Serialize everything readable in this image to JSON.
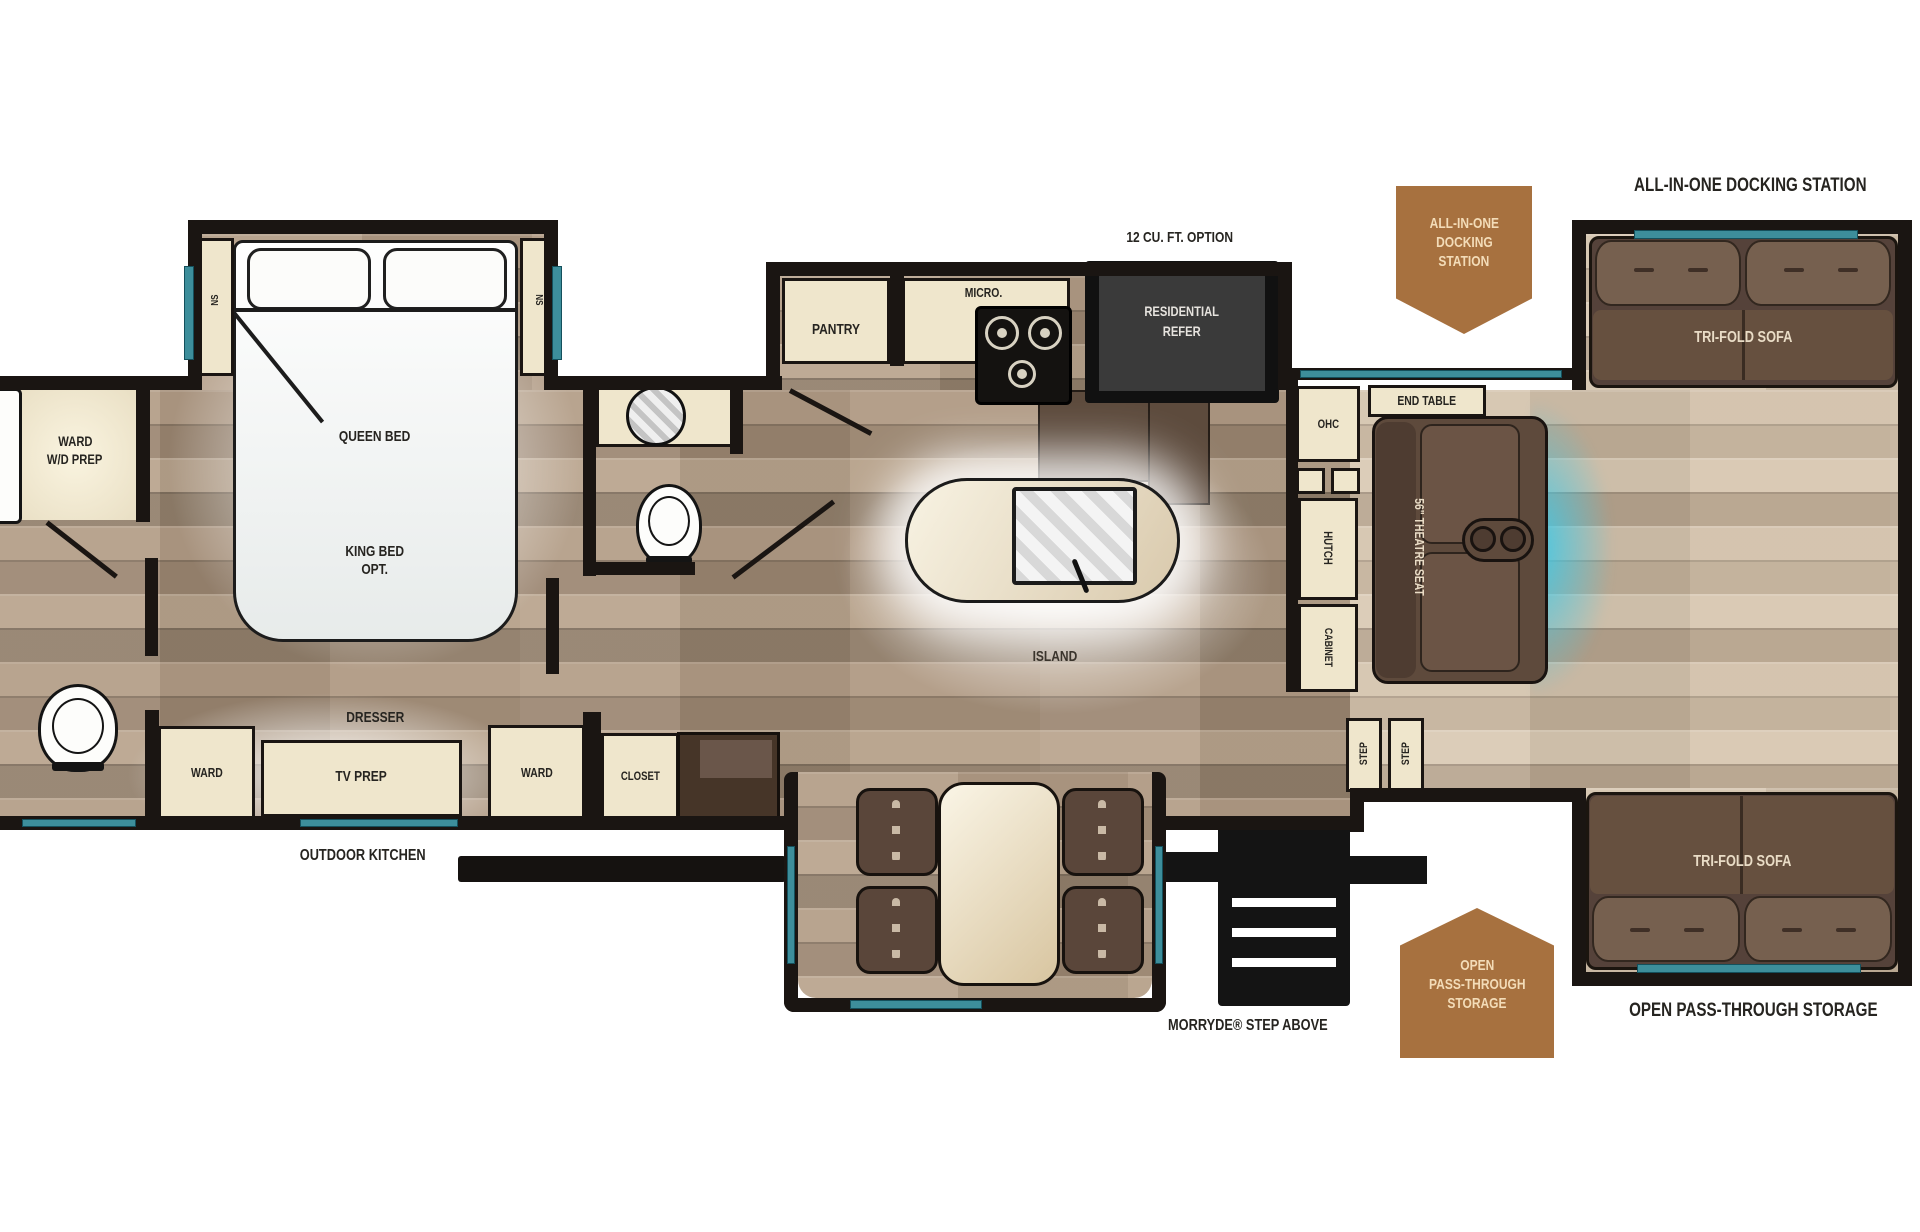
{
  "colors": {
    "window_teal": "#3d8e9b",
    "glow_cyan": "#3cc9e8",
    "badge_brown": "#a7713f",
    "badge_text": "#f3dcb8",
    "wall_black": "#1a1512",
    "floor_medium": "#a8937e",
    "floor_light": "#cdbba5",
    "cabinet_cream": "#efe6cc",
    "sofa_brown": "#66503f",
    "refer_dark": "#3a3a3a",
    "label_dark": "#262420"
  },
  "bedroom": {
    "queen_bed": "QUEEN BED",
    "king_bed_line1": "KING BED",
    "king_bed_line2": "OPT.",
    "nightstand_left": "NS",
    "nightstand_right": "NS",
    "ward_wd_line1": "WARD",
    "ward_wd_line2": "W/D PREP",
    "dresser": "DRESSER",
    "tv_prep": "TV PREP",
    "ward_front": "WARD",
    "ward_hall": "WARD",
    "closet": "CLOSET"
  },
  "kitchen": {
    "pantry": "PANTRY",
    "micro": "MICRO.",
    "refer_option": "12 CU. FT. OPTION",
    "refer_line1": "RESIDENTIAL",
    "refer_line2": "REFER",
    "island": "ISLAND",
    "ohc": "OHC",
    "hutch": "HUTCH",
    "cabinet": "CABINET"
  },
  "living": {
    "end_table": "END TABLE",
    "theatre_seat": "56\" THEATRE SEAT",
    "sofa_top": "TRI-FOLD SOFA",
    "sofa_bottom": "TRI-FOLD SOFA",
    "docking_station": "ALL-IN-ONE DOCKING STATION",
    "pass_through": "OPEN PASS-THROUGH STORAGE"
  },
  "badges": {
    "docking_line1": "ALL-IN-ONE",
    "docking_line2": "DOCKING",
    "docking_line3": "STATION",
    "storage_line1": "OPEN",
    "storage_line2": "PASS-THROUGH",
    "storage_line3": "STORAGE"
  },
  "entry": {
    "morryde": "MORRYDE® STEP ABOVE",
    "step_left": "STEP",
    "step_right": "STEP",
    "outdoor_kitchen": "OUTDOOR KITCHEN"
  }
}
